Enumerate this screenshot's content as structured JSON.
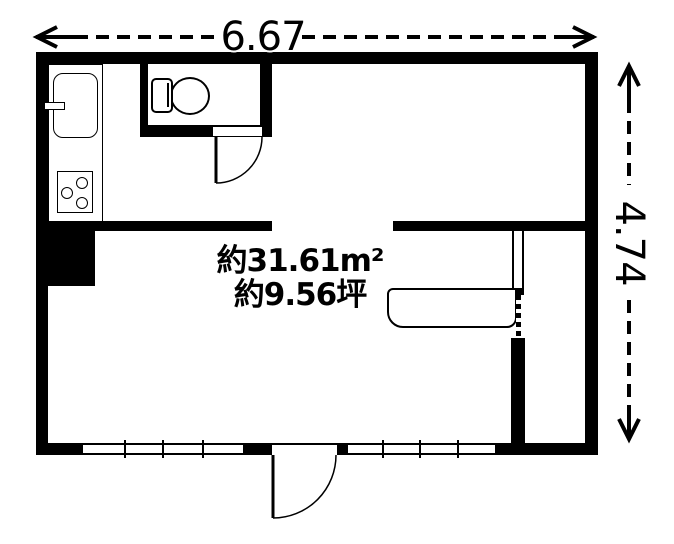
{
  "labels": {
    "width_dimension": "6.67",
    "height_dimension": "4.74",
    "area_m2": "約31.61m²",
    "area_tsubo": "約9.56坪"
  },
  "colors": {
    "wall": "#000000",
    "line": "#000000",
    "background": "#ffffff"
  }
}
